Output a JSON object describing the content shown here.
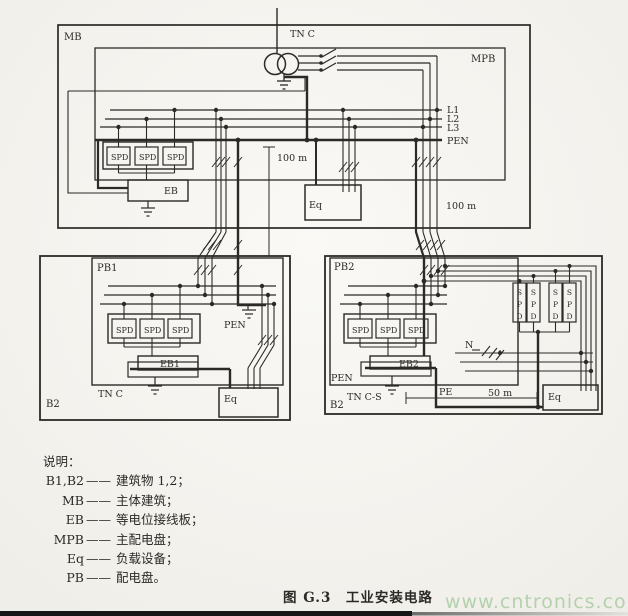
{
  "d": {
    "shared": {
      "spd": "SPD",
      "s": "S",
      "p": "P",
      "d": "D"
    },
    "top": {
      "mb": "MB",
      "tn_c": "TN C",
      "mpb": "MPB",
      "l1": "L1",
      "l2": "L2",
      "l3": "L3",
      "pen": "PEN",
      "eb": "EB",
      "eq": "Eq",
      "dist_left": "100 m",
      "dist_right": "100 m"
    },
    "b1": {
      "pb1": "PB1",
      "eb1": "EB1",
      "pen": "PEN",
      "tn_c": "TN C",
      "b": "B2",
      "eq": "Eq"
    },
    "b2": {
      "pb2": "PB2",
      "eb2": "EB2",
      "pen": "PEN",
      "tn_c_s": "TN C-S",
      "b": "B2",
      "eq": "Eq",
      "n": "N",
      "pe": "PE",
      "dist": "50 m"
    }
  },
  "legend": {
    "title": "说明：",
    "dash": "——",
    "items": [
      {
        "abbr": "B1,B2",
        "def": "建筑物 1,2；"
      },
      {
        "abbr": "MB",
        "def": "主体建筑；"
      },
      {
        "abbr": "EB",
        "def": "等电位接线板；"
      },
      {
        "abbr": "MPB",
        "def": "主配电盘；"
      },
      {
        "abbr": "Eq",
        "def": "负载设备；"
      },
      {
        "abbr": "PB",
        "def": "配电盘。"
      }
    ]
  },
  "caption": "图 G.3　工业安装电路",
  "watermark": "www.cntronics.com",
  "colors": {
    "ink": "#2c2a27",
    "paper": "#f7f5f1",
    "watermark_green": "#b4d1ad",
    "bottom_bar": "#171717"
  }
}
